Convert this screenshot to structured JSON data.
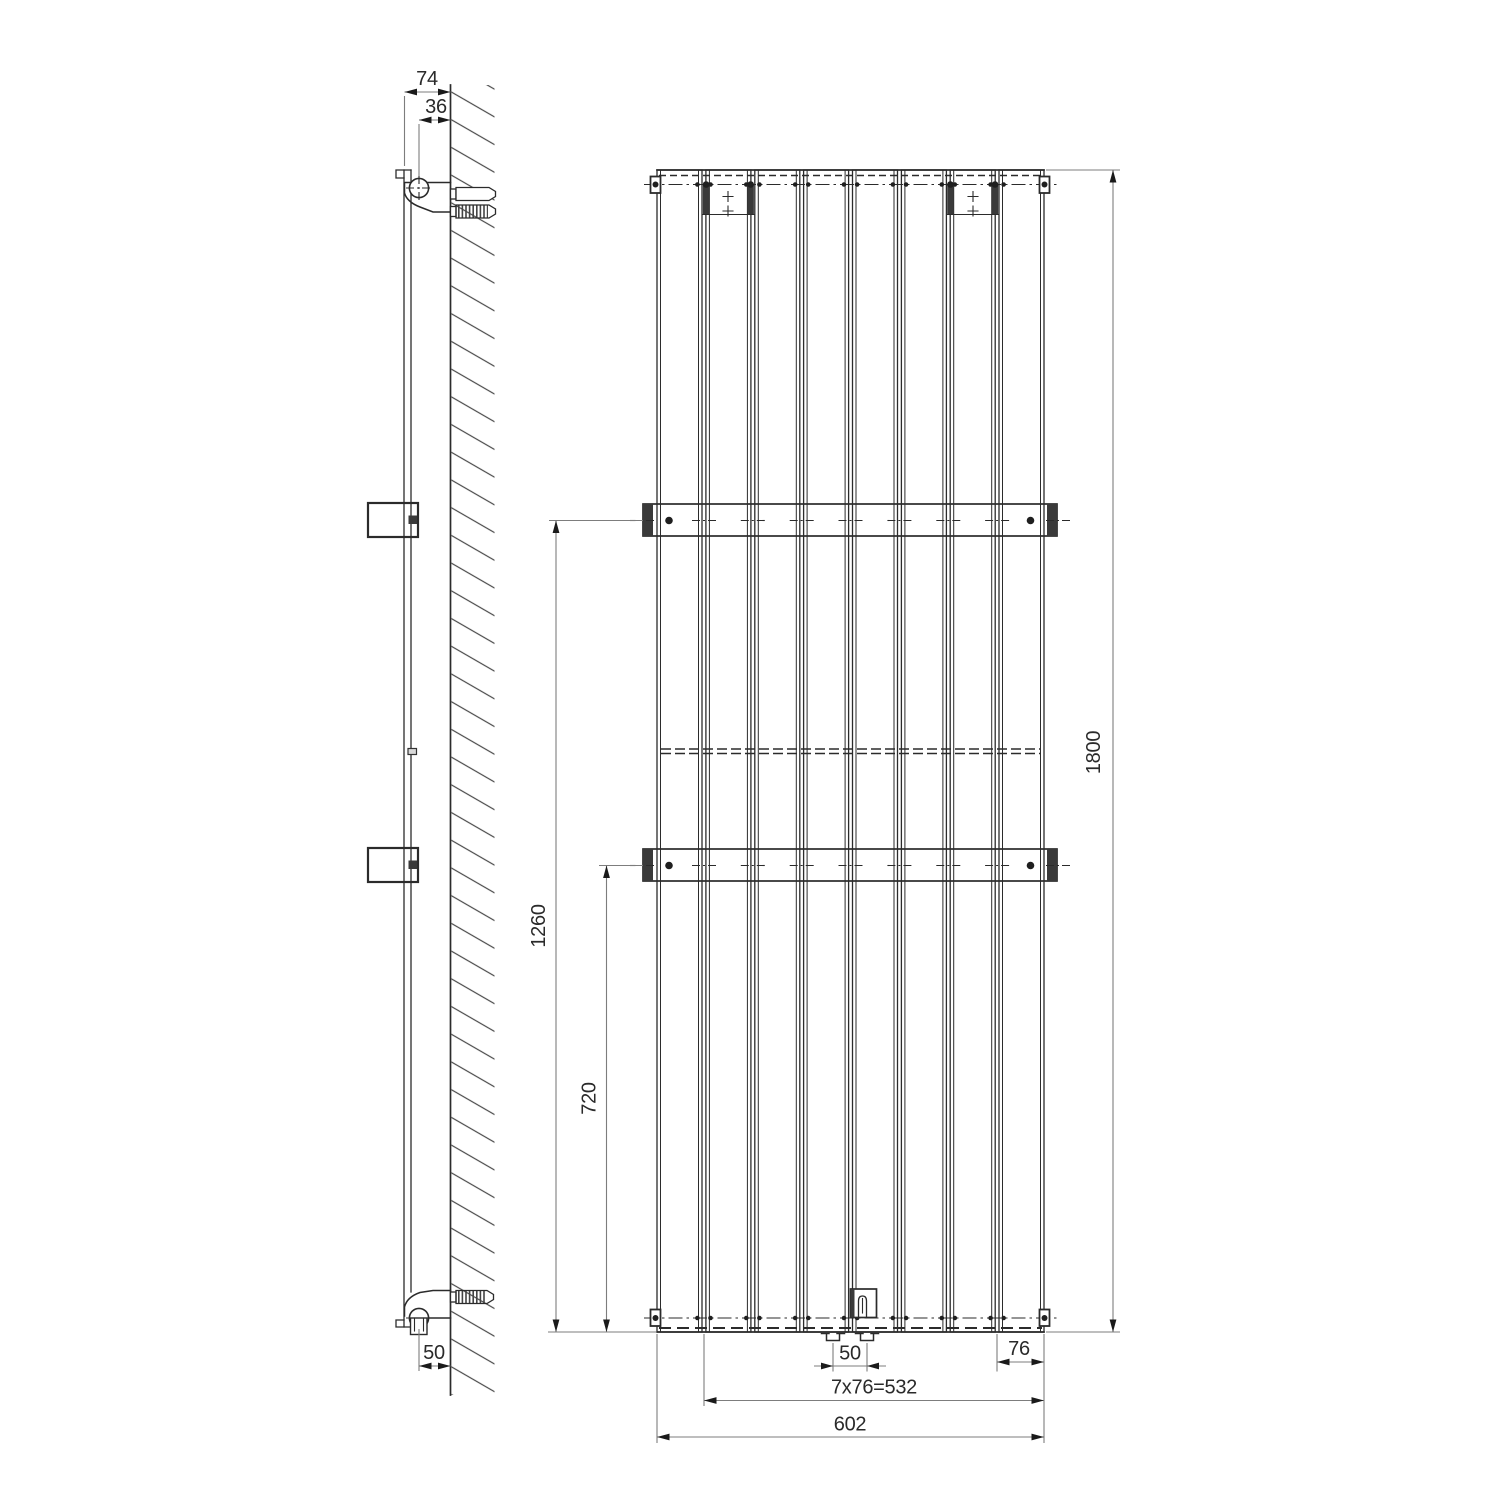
{
  "drawing": {
    "type": "technical dimension drawing",
    "subject": "vertical flat-panel radiator with wall-mounting brackets",
    "views": [
      {
        "id": "side",
        "label": "side section at wall"
      },
      {
        "id": "front",
        "label": "front elevation"
      }
    ],
    "panel_count": 8,
    "mounting_rail_count": 2
  },
  "dims": {
    "depth_total": "74",
    "pipe_axis_to_wall": "36",
    "bottom_valve_to_wall": "50",
    "upper_rail_from_bottom": "1260",
    "lower_rail_from_bottom": "720",
    "overall_height": "1800",
    "valve_connection_spacing": "50",
    "edge_panel_pitch": "76",
    "panel_pitch_total": "7x76=532",
    "overall_width": "602"
  },
  "colors": {
    "line": "#2b2b2b",
    "dimension": "#7d7d7d",
    "text": "#2a2a2a",
    "background": "#ffffff"
  }
}
